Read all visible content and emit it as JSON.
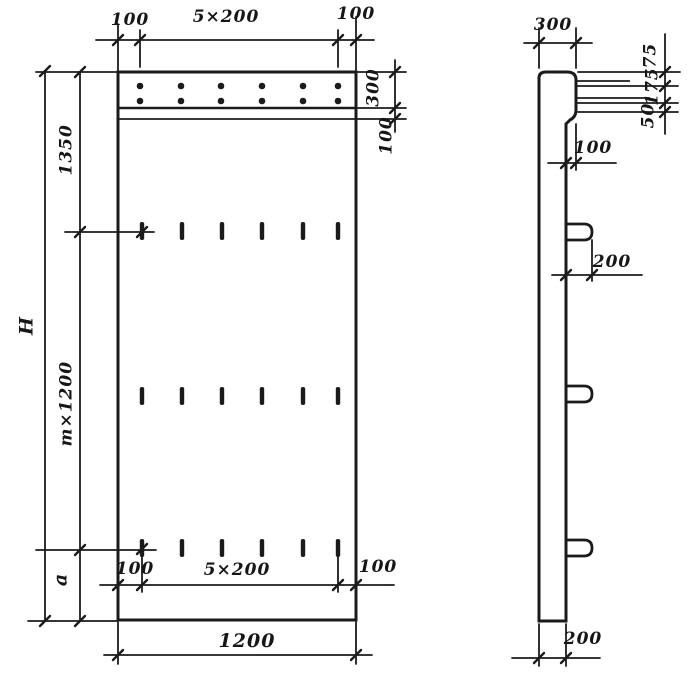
{
  "front_view": {
    "top_dims": {
      "left": "100",
      "span": "5×200",
      "right": "100"
    },
    "right_dims": {
      "band": "300",
      "offset": "100"
    },
    "left_dims": {
      "total": "H",
      "upper": "1350",
      "middle": "m×1200",
      "lower": "a"
    },
    "bottom_dims": {
      "left": "100",
      "span": "5×200",
      "right": "100",
      "width": "1200"
    }
  },
  "side_view": {
    "top_dim": "300",
    "right_dims": {
      "top": "75",
      "middle": "175",
      "bottom": "50"
    },
    "offset_dim": "100",
    "hook_dim": "200",
    "thickness_dim": "200"
  },
  "geometry": {
    "hole_rows": 2,
    "holes_per_row": 6,
    "slot_rows": 3,
    "slots_per_row": 6,
    "side_hooks": 3
  },
  "colors": {
    "ink": "#1b1b1b",
    "paper": "#ffffff"
  }
}
